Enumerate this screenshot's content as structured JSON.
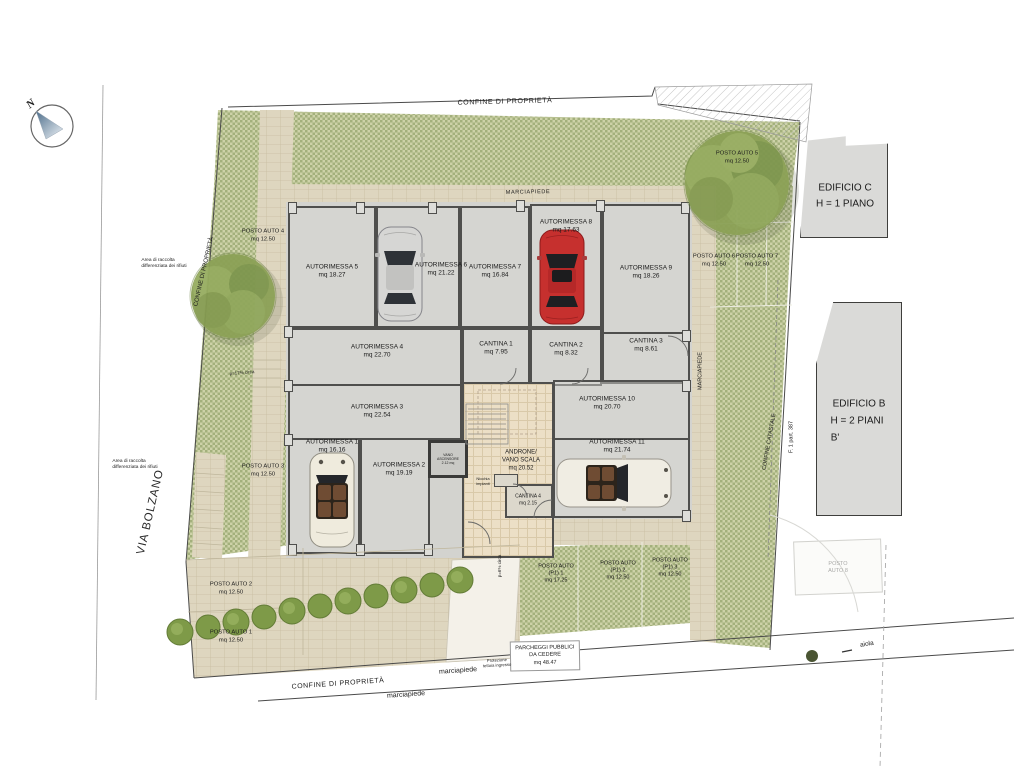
{
  "compass": {
    "north": "N"
  },
  "boundaries": {
    "top": "CONFINE DI PROPRIETÀ",
    "left": "CONFINE DI PROPRIETÀ",
    "bottom": "CONFINE DI PROPRIETÀ",
    "catastale": "CONFINE CATASTALE",
    "parcel": "F. 1 part. 387"
  },
  "street": "VIA BOLZANO",
  "sidewalk": {
    "top": "MARCIAPIEDE",
    "right": "MARCIAPIEDE",
    "bottom": "marciapiede",
    "bottom2": "marciapiede"
  },
  "buildings": {
    "c": {
      "name": "EDIFICIO C",
      "height": "H = 1 PIANO"
    },
    "b": {
      "name": "EDIFICIO B",
      "height": "H = 2 PIANI",
      "note": "B'"
    }
  },
  "garages": [
    {
      "name": "AUTORIMESSA 1",
      "area": "mq 16.16"
    },
    {
      "name": "AUTORIMESSA 2",
      "area": "mq 19.19"
    },
    {
      "name": "AUTORIMESSA 3",
      "area": "mq 22.54"
    },
    {
      "name": "AUTORIMESSA 4",
      "area": "mq 22.70"
    },
    {
      "name": "AUTORIMESSA 5",
      "area": "mq 18.27"
    },
    {
      "name": "AUTORIMESSA 6",
      "area": "mq 21.22"
    },
    {
      "name": "AUTORIMESSA 7",
      "area": "mq 16.84"
    },
    {
      "name": "AUTORIMESSA 8",
      "area": "mq 17.63"
    },
    {
      "name": "AUTORIMESSA 9",
      "area": "mq 18.26"
    },
    {
      "name": "AUTORIMESSA 10",
      "area": "mq 20.70"
    },
    {
      "name": "AUTORIMESSA 11",
      "area": "mq 21.74"
    }
  ],
  "cellars": [
    {
      "name": "CANTINA 1",
      "area": "mq 7.95"
    },
    {
      "name": "CANTINA 2",
      "area": "mq 8.32"
    },
    {
      "name": "CANTINA 3",
      "area": "mq 8.61"
    },
    {
      "name": "CANTINA 4",
      "area": "mq 2.15"
    }
  ],
  "hall": {
    "line1": "ANDRONE/",
    "line2": "VANO SCALA",
    "area": "mq 20.52"
  },
  "elevator": {
    "name": "VANO ASCENSORE",
    "area": "2.12 mq"
  },
  "niche": {
    "line1": "Nicchia",
    "line2": "impianti"
  },
  "parking": [
    {
      "name": "POSTO AUTO 1",
      "area": "mq 12.50"
    },
    {
      "name": "POSTO AUTO 2",
      "area": "mq 12.50"
    },
    {
      "name": "POSTO AUTO 3",
      "area": "mq 12.50"
    },
    {
      "name": "POSTO AUTO 4",
      "area": "mq 12.50"
    },
    {
      "name": "POSTO AUTO 5",
      "area": "mq 12.50"
    },
    {
      "name": "POSTO AUTO 6",
      "area": "mq 12.50"
    },
    {
      "name": "POSTO AUTO 7",
      "area": "mq 12.50"
    }
  ],
  "parking8": {
    "line1": "POSTO",
    "line2": "AUTO 8"
  },
  "p1": [
    {
      "name": "POSTO AUTO",
      "sub": "(P1) 1",
      "area": "mq 17.25"
    },
    {
      "name": "POSTO AUTO",
      "sub": "(P1) 2",
      "area": "mq 12.50"
    },
    {
      "name": "POSTO AUTO",
      "sub": "(P1) 3",
      "area": "mq 12.50"
    }
  ],
  "public_parking": {
    "line1": "PARCHEGGI PUBBLICI",
    "line2": "DA CEDERE",
    "area": "mq 48.47"
  },
  "waste": {
    "line1": "Area di raccolta",
    "line2": "differenziata dei rifiuti"
  },
  "slopes": {
    "ramp": "p=17% circa",
    "entry": "p=6% circa"
  },
  "canopy": {
    "line1": "Protezione",
    "line2": "tettoia ingresso"
  },
  "flowerbed": "aiola",
  "colors": {
    "green": "#cdd2a8",
    "green_check": "#a3b07c",
    "paver": "#ded6bf",
    "concrete": "#d3d3cf",
    "red_car": "#c6302e"
  }
}
